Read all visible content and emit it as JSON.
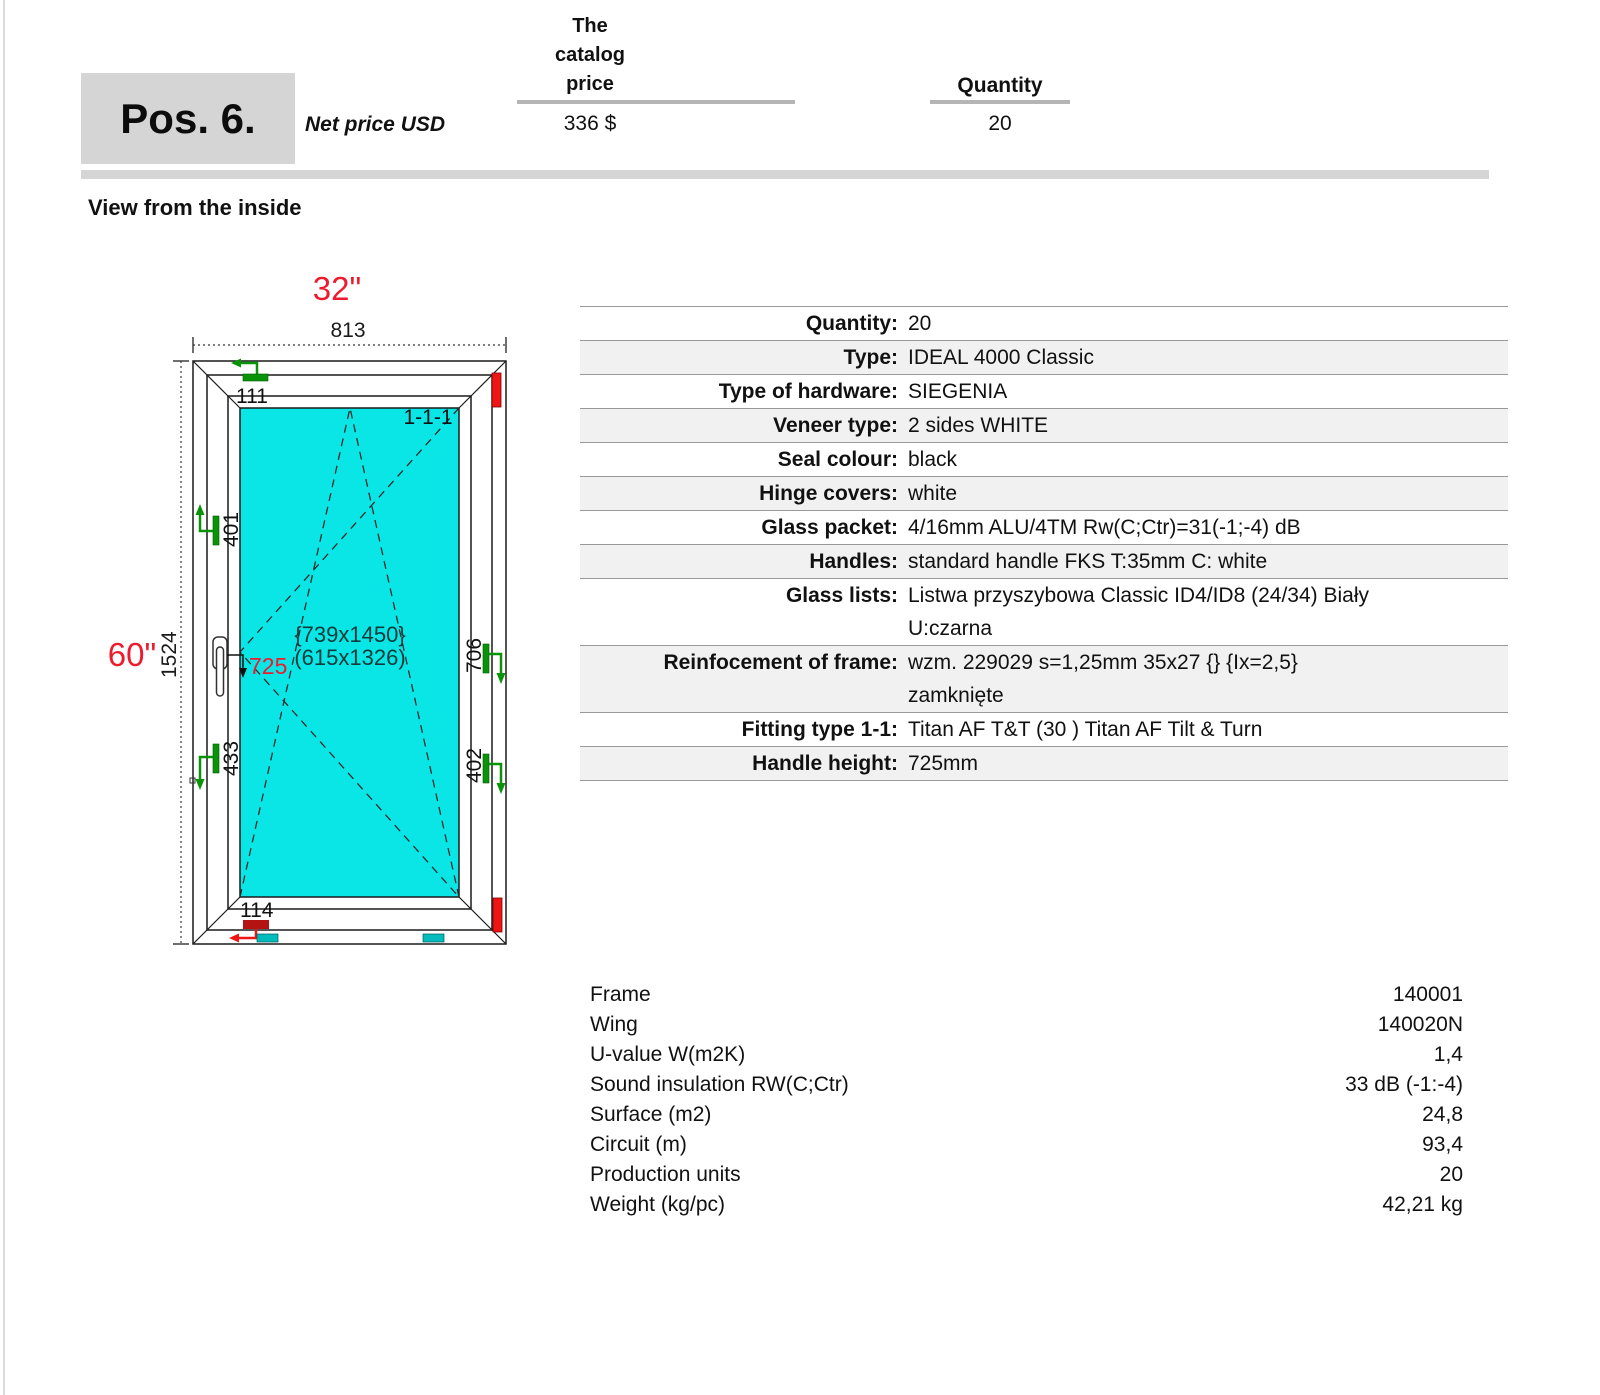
{
  "header": {
    "pos": "Pos. 6.",
    "net_price_label": "Net price USD",
    "catalog_price_label": "The\ncatalog\nprice",
    "catalog_price_value": "336 $",
    "quantity_label": "Quantity",
    "quantity_value": "20"
  },
  "view_label": "View from the inside",
  "diagram": {
    "width_inches": "32\"",
    "width_mm": "813",
    "height_inches": "60\"",
    "height_mm": "1524",
    "sash_code": "1-1-1",
    "glass_size_braced": "{739x1450}",
    "glass_size_paren": "(615x1326)",
    "handle_height_mm": "725",
    "mark_top": "111",
    "mark_left_upper": "401",
    "mark_left_lower": "433",
    "mark_right_upper": "706",
    "mark_right_lower": "402",
    "mark_bottom": "114",
    "colors": {
      "dimension_red": "#ed1b2e",
      "hinge_green": "#089308",
      "glass_cyan": "#0ae6e6",
      "frame_mark_red": "#ef1515",
      "drain_teal": "#00bcbc"
    }
  },
  "spec": {
    "rows": [
      {
        "label": "Quantity:",
        "value": "20"
      },
      {
        "label": "Type:",
        "value": "IDEAL 4000 Classic"
      },
      {
        "label": "Type of hardware:",
        "value": "SIEGENIA"
      },
      {
        "label": "Veneer type:",
        "value": "2 sides WHITE"
      },
      {
        "label": "Seal colour:",
        "value": "black"
      },
      {
        "label": "Hinge covers:",
        "value": "white"
      },
      {
        "label": "Glass packet:",
        "value": "4/16mm ALU/4TM Rw(C;Ctr)=31(-1;-4) dB"
      },
      {
        "label": "Handles:",
        "value": "standard handle FKS T:35mm C: white"
      },
      {
        "label": "Glass lists:",
        "value": "Listwa przyszybowa Classic ID4/ID8 (24/34) Biały\nU:czarna"
      },
      {
        "label": "Reinfocement of frame:",
        "value": "wzm. 229029 s=1,25mm 35x27 {} {Ix=2,5}\nzamknięte"
      },
      {
        "label": "Fitting type 1-1:",
        "value": "Titan AF T&T (30 ) Titan AF Tilt & Turn"
      },
      {
        "label": "Handle height:",
        "value": "725mm"
      }
    ]
  },
  "summary": {
    "rows": [
      {
        "label": "Frame",
        "value": "140001"
      },
      {
        "label": "Wing",
        "value": "140020N"
      },
      {
        "label": "U-value W(m2K)",
        "value": "1,4"
      },
      {
        "label": "Sound insulation RW(C;Ctr)",
        "value": "33 dB (-1:-4)"
      },
      {
        "label": "Surface (m2)",
        "value": "24,8"
      },
      {
        "label": "Circuit (m)",
        "value": "93,4"
      },
      {
        "label": "Production units",
        "value": "20"
      },
      {
        "label": "Weight (kg/pc)",
        "value": "42,21 kg"
      }
    ]
  }
}
